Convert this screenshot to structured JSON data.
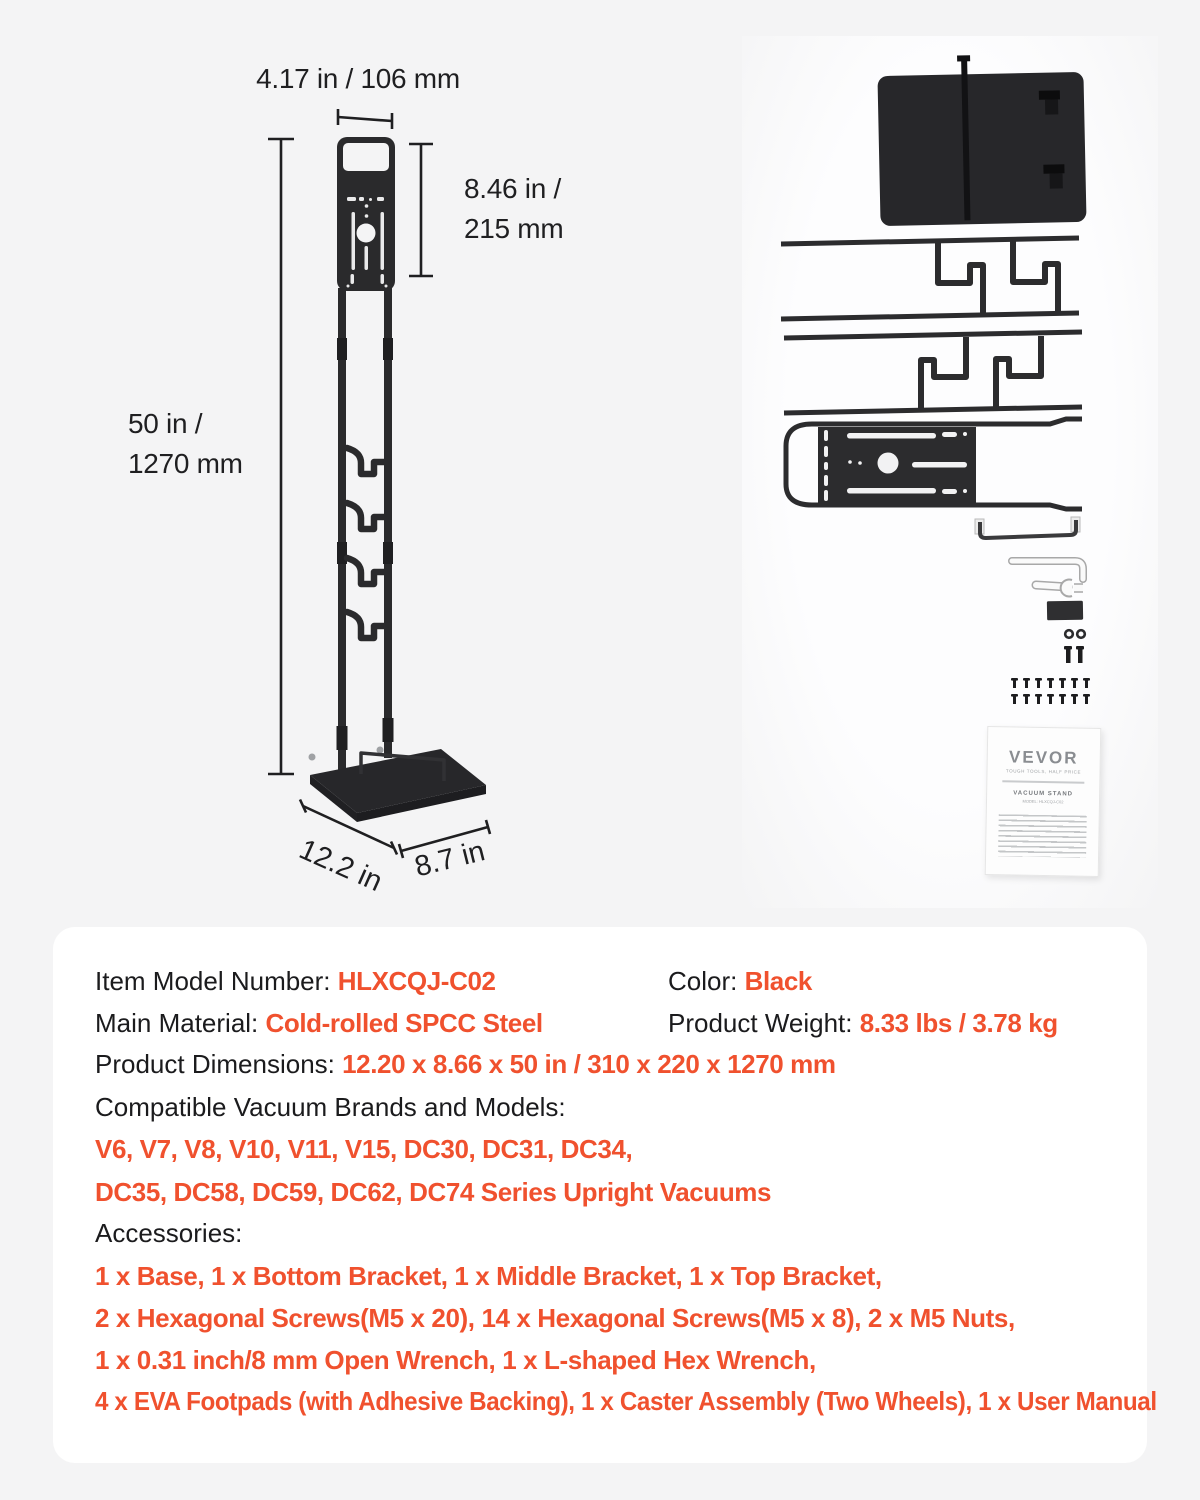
{
  "accent": "#F0512E",
  "diagram": {
    "dim_width": "4.17 in / 106 mm",
    "dim_bracket_line1": "8.46 in /",
    "dim_bracket_line2": "215 mm",
    "dim_height_line1": "50 in /",
    "dim_height_line2": "1270 mm",
    "dim_base_depth": "12.2 in",
    "dim_base_width": "8.7 in"
  },
  "manual": {
    "brand": "VEVOR",
    "tagline": "TOUGH TOOLS, HALF PRICE",
    "title": "VACUUM STAND",
    "model": "MODEL: HLXCQJ-C02"
  },
  "specs": {
    "item_model_label": "Item Model Number: ",
    "item_model_value": "HLXCQJ-C02",
    "color_label": "Color: ",
    "color_value": "Black",
    "material_label": "Main Material: ",
    "material_value": "Cold-rolled SPCC Steel",
    "weight_label": "Product Weight: ",
    "weight_value": "8.33 lbs / 3.78 kg",
    "dimensions_label": "Product Dimensions: ",
    "dimensions_value": "12.20 x 8.66 x 50 in / 310 x 220 x 1270 mm",
    "compatible_label": "Compatible Vacuum Brands and Models:",
    "compatible_line1": "V6, V7, V8, V10, V11, V15, DC30, DC31, DC34,",
    "compatible_line2": "DC35, DC58, DC59, DC62, DC74 Series Upright Vacuums",
    "accessories_label": "Accessories:",
    "accessories_line1": "1 x Base, 1 x Bottom Bracket, 1 x Middle Bracket, 1 x Top Bracket,",
    "accessories_line2": "2 x Hexagonal Screws(M5 x 20), 14 x Hexagonal Screws(M5 x 8), 2 x M5 Nuts,",
    "accessories_line3": "1 x 0.31 inch/8 mm Open Wrench, 1 x L-shaped Hex Wrench,",
    "accessories_line4": "4 x EVA Footpads (with Adhesive Backing), 1 x Caster Assembly (Two Wheels), 1 x User Manual"
  }
}
